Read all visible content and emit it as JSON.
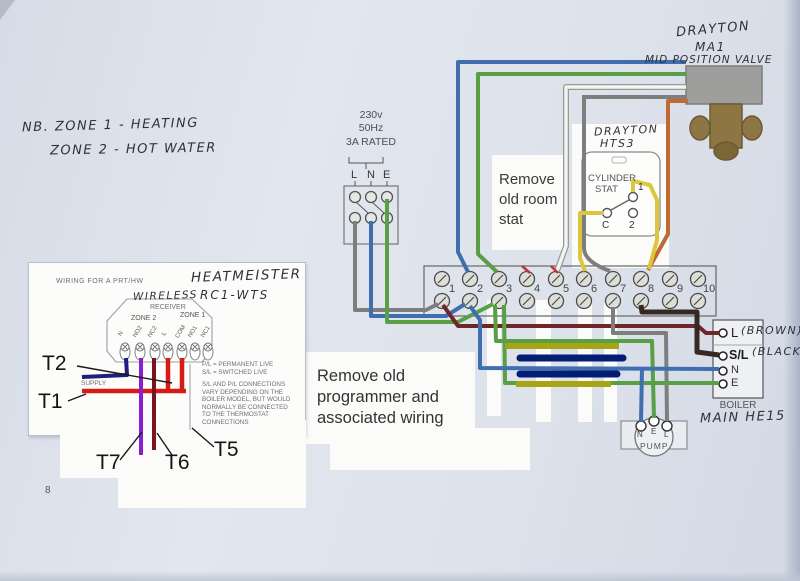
{
  "notes": {
    "nb_line1": "NB. ZONE 1  -  HEATING",
    "nb_line2": "ZONE 2  -  HOT WATER",
    "room_stat": [
      "Remove",
      "old room",
      "stat"
    ],
    "programmer": [
      "Remove old",
      "programmer and",
      "associated wiring"
    ]
  },
  "valve": {
    "brand": "DRAYTON",
    "model": "MA1",
    "type": "MID POSITION VALVE"
  },
  "supply": {
    "voltage": "230v",
    "frequency": "50Hz",
    "rating": "3A RATED",
    "terminals": [
      "L",
      "N",
      "E"
    ]
  },
  "cylinder_stat": {
    "brand": "DRAYTON",
    "model": "HTS3",
    "line1": "CYLINDER",
    "line2": "STAT",
    "terminals": [
      "1",
      "C",
      "2"
    ]
  },
  "terminal_strip": {
    "numbers": [
      "1",
      "2",
      "3",
      "4",
      "5",
      "6",
      "7",
      "8",
      "9",
      "10"
    ]
  },
  "boiler": {
    "terminals": [
      {
        "label": "L",
        "note": "(BROWN)"
      },
      {
        "label": "S/L",
        "note": "(BLACK)"
      },
      {
        "label": "N",
        "note": ""
      },
      {
        "label": "E",
        "note": ""
      }
    ],
    "label": "BOILER",
    "model": "MAIN HE15"
  },
  "pump": {
    "terminals": [
      "N",
      "E",
      "L"
    ],
    "label": "PUMP"
  },
  "inset": {
    "heading": "WIRING FOR A PRT/HW",
    "brand": "HEATMEISTER",
    "model": "RC1-WTS",
    "wireless": "WIRELESS",
    "receiver": "RECEIVER",
    "zone2": "ZONE 2",
    "zone1": "ZONE 1",
    "terminals": [
      "N",
      "NO2",
      "NC2",
      "L",
      "COM",
      "NO1",
      "NC1"
    ],
    "supply_label": "SUPPLY",
    "legend": [
      "P/L = PERMANENT LIVE",
      "S/L = SWITCHED LIVE"
    ],
    "note": [
      "S/L AND P/L CONNECTIONS",
      "VARY DEPENDING ON THE",
      "BOILER MODEL, BUT WOULD",
      "NORMALLY BE CONNECTED",
      "TO THE THERMOSTAT",
      "CONNECTIONS"
    ],
    "tags": {
      "t1": "T1",
      "t2": "T2",
      "t5": "T5",
      "t6": "T6",
      "t7": "T7"
    },
    "page_number": "8"
  },
  "colors": {
    "paper": "#dce2ec",
    "wire_blue": "#3f6fae",
    "wire_green": "#57a046",
    "wire_grey": "#7e7e7e",
    "wire_white": "#f4f4f1",
    "wire_orange": "#c06a31",
    "wire_yellow": "#dcc63e",
    "wire_olive": "#a9a416",
    "wire_navy_annotation": "#021e74",
    "wire_maroon": "#6f2629",
    "wire_dark_brown": "#362822",
    "wire_red": "#d41b15",
    "wire_purple": "#8b1fd0",
    "wire_navy_inset": "#20207a"
  }
}
